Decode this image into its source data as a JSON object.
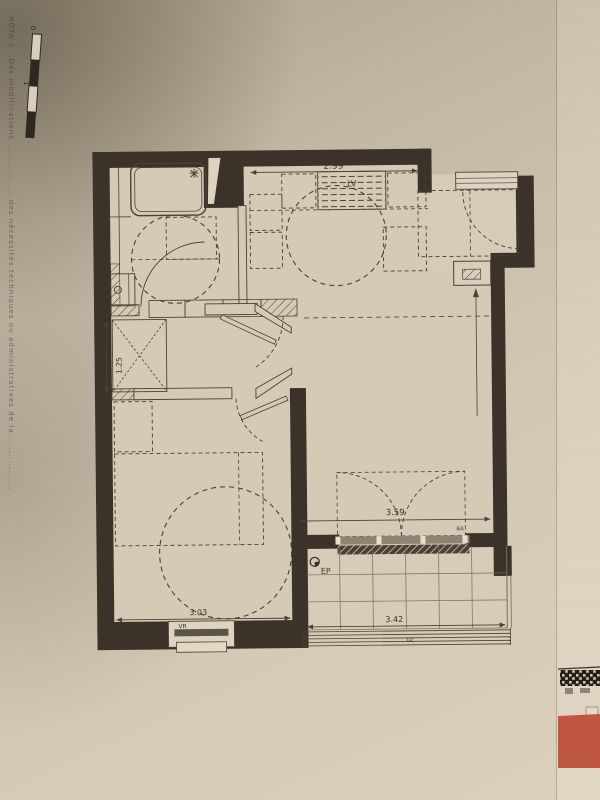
{
  "photo": {
    "paper_light": "#d6cbb7",
    "paper_mid": "#cdc2ae",
    "paper_shadow": "#aba188",
    "wall_color": "#3b3329",
    "ink_color": "#4c4133",
    "ink_faint": "#7a6b58",
    "red_inset": "#bf5740"
  },
  "margin": {
    "note": "NOTA 1 : Des modifications ................ des nécessités techniques ou administratives de la ................",
    "scale_zero": "0",
    "scale_one": "1"
  },
  "plan": {
    "dimensions": {
      "kitchen_width": "2.99",
      "closet_width": "1.25",
      "bedroom_width": "3.03",
      "living_door_width": "3.59",
      "balcony_width": "3.42"
    },
    "tags": {
      "dishwasher": "LV",
      "roller_shutter": "VR",
      "rain_pipe": "EP",
      "window_tag": "BA",
      "railing_tag": "GC"
    }
  }
}
